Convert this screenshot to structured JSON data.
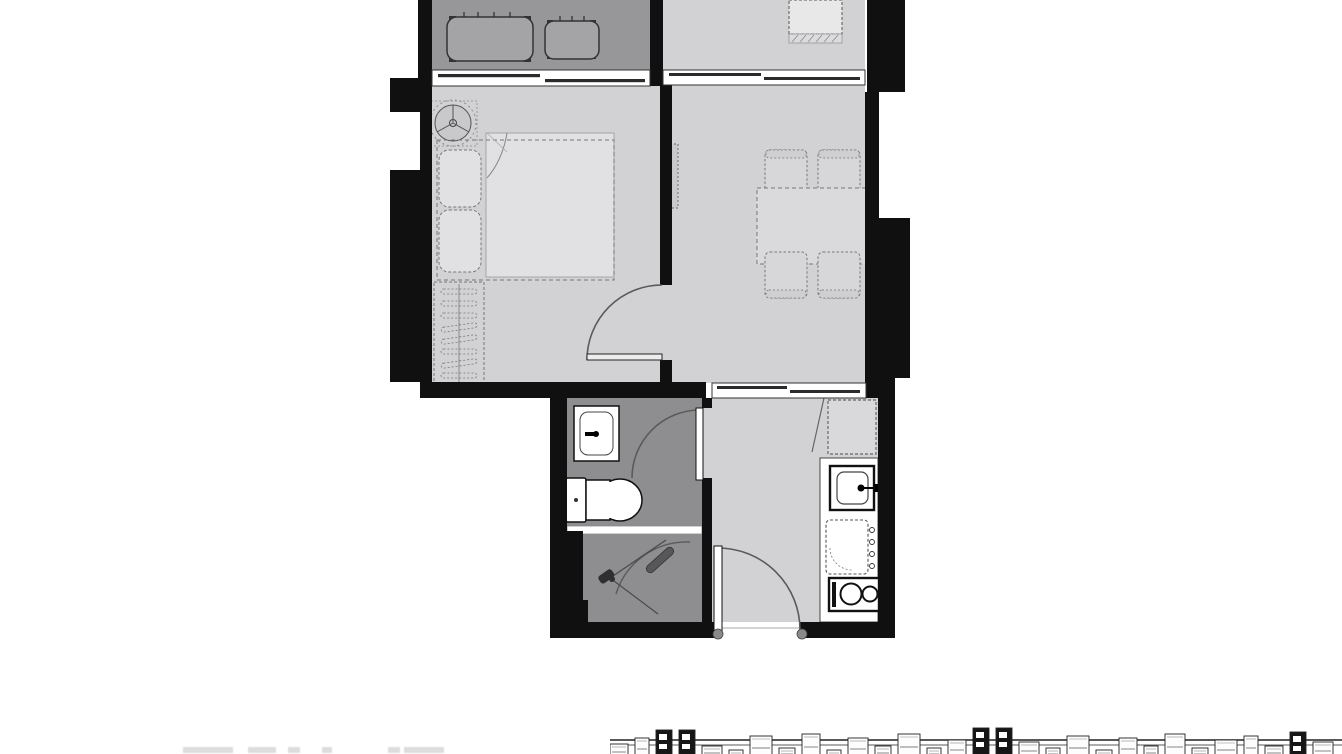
{
  "document": {
    "kind": "apartment-floor-plan",
    "visible_text": ""
  },
  "palette": {
    "wall": "#101010",
    "floor": "#d2d2d4",
    "balcony": "#97979a",
    "bath": "#8e8e91",
    "mattress": "#e1e1e3",
    "counter": "#ffffff",
    "line": "#666668",
    "dark": "#1c1c1c",
    "table": "#dadadc",
    "chair": "#d7d7d9",
    "fridge": "#d9d9db",
    "acfill": "#a4a4a7"
  },
  "caption_fragments": [
    {
      "x": 183,
      "w": 50
    },
    {
      "x": 248,
      "w": 28
    },
    {
      "x": 288,
      "w": 12
    },
    {
      "x": 322,
      "w": 10
    },
    {
      "x": 388,
      "w": 12
    },
    {
      "x": 404,
      "w": 40
    }
  ],
  "site_strip": {
    "gap": 7,
    "modules": [
      {
        "w": 18,
        "h": 16,
        "dark": false
      },
      {
        "w": 14,
        "h": 22,
        "dark": false
      },
      {
        "w": 16,
        "h": 30,
        "dark": true
      },
      {
        "w": 16,
        "h": 30,
        "dark": true
      },
      {
        "w": 20,
        "h": 14,
        "dark": false
      },
      {
        "w": 14,
        "h": 10,
        "dark": false
      },
      {
        "w": 22,
        "h": 24,
        "dark": false
      },
      {
        "w": 16,
        "h": 12,
        "dark": false
      },
      {
        "w": 18,
        "h": 26,
        "dark": false
      },
      {
        "w": 14,
        "h": 10,
        "dark": false
      },
      {
        "w": 20,
        "h": 22,
        "dark": false
      },
      {
        "w": 16,
        "h": 14,
        "dark": false
      },
      {
        "w": 22,
        "h": 26,
        "dark": false
      },
      {
        "w": 14,
        "h": 12,
        "dark": false
      },
      {
        "w": 18,
        "h": 20,
        "dark": false
      },
      {
        "w": 16,
        "h": 32,
        "dark": true
      },
      {
        "w": 16,
        "h": 32,
        "dark": true
      },
      {
        "w": 20,
        "h": 18,
        "dark": false
      },
      {
        "w": 14,
        "h": 12,
        "dark": false
      },
      {
        "w": 22,
        "h": 24,
        "dark": false
      },
      {
        "w": 16,
        "h": 10,
        "dark": false
      },
      {
        "w": 18,
        "h": 22,
        "dark": false
      },
      {
        "w": 14,
        "h": 14,
        "dark": false
      },
      {
        "w": 20,
        "h": 26,
        "dark": false
      },
      {
        "w": 16,
        "h": 12,
        "dark": false
      },
      {
        "w": 22,
        "h": 20,
        "dark": false
      },
      {
        "w": 14,
        "h": 24,
        "dark": false
      },
      {
        "w": 18,
        "h": 14,
        "dark": false
      },
      {
        "w": 16,
        "h": 28,
        "dark": true
      },
      {
        "w": 20,
        "h": 18,
        "dark": false
      }
    ]
  }
}
